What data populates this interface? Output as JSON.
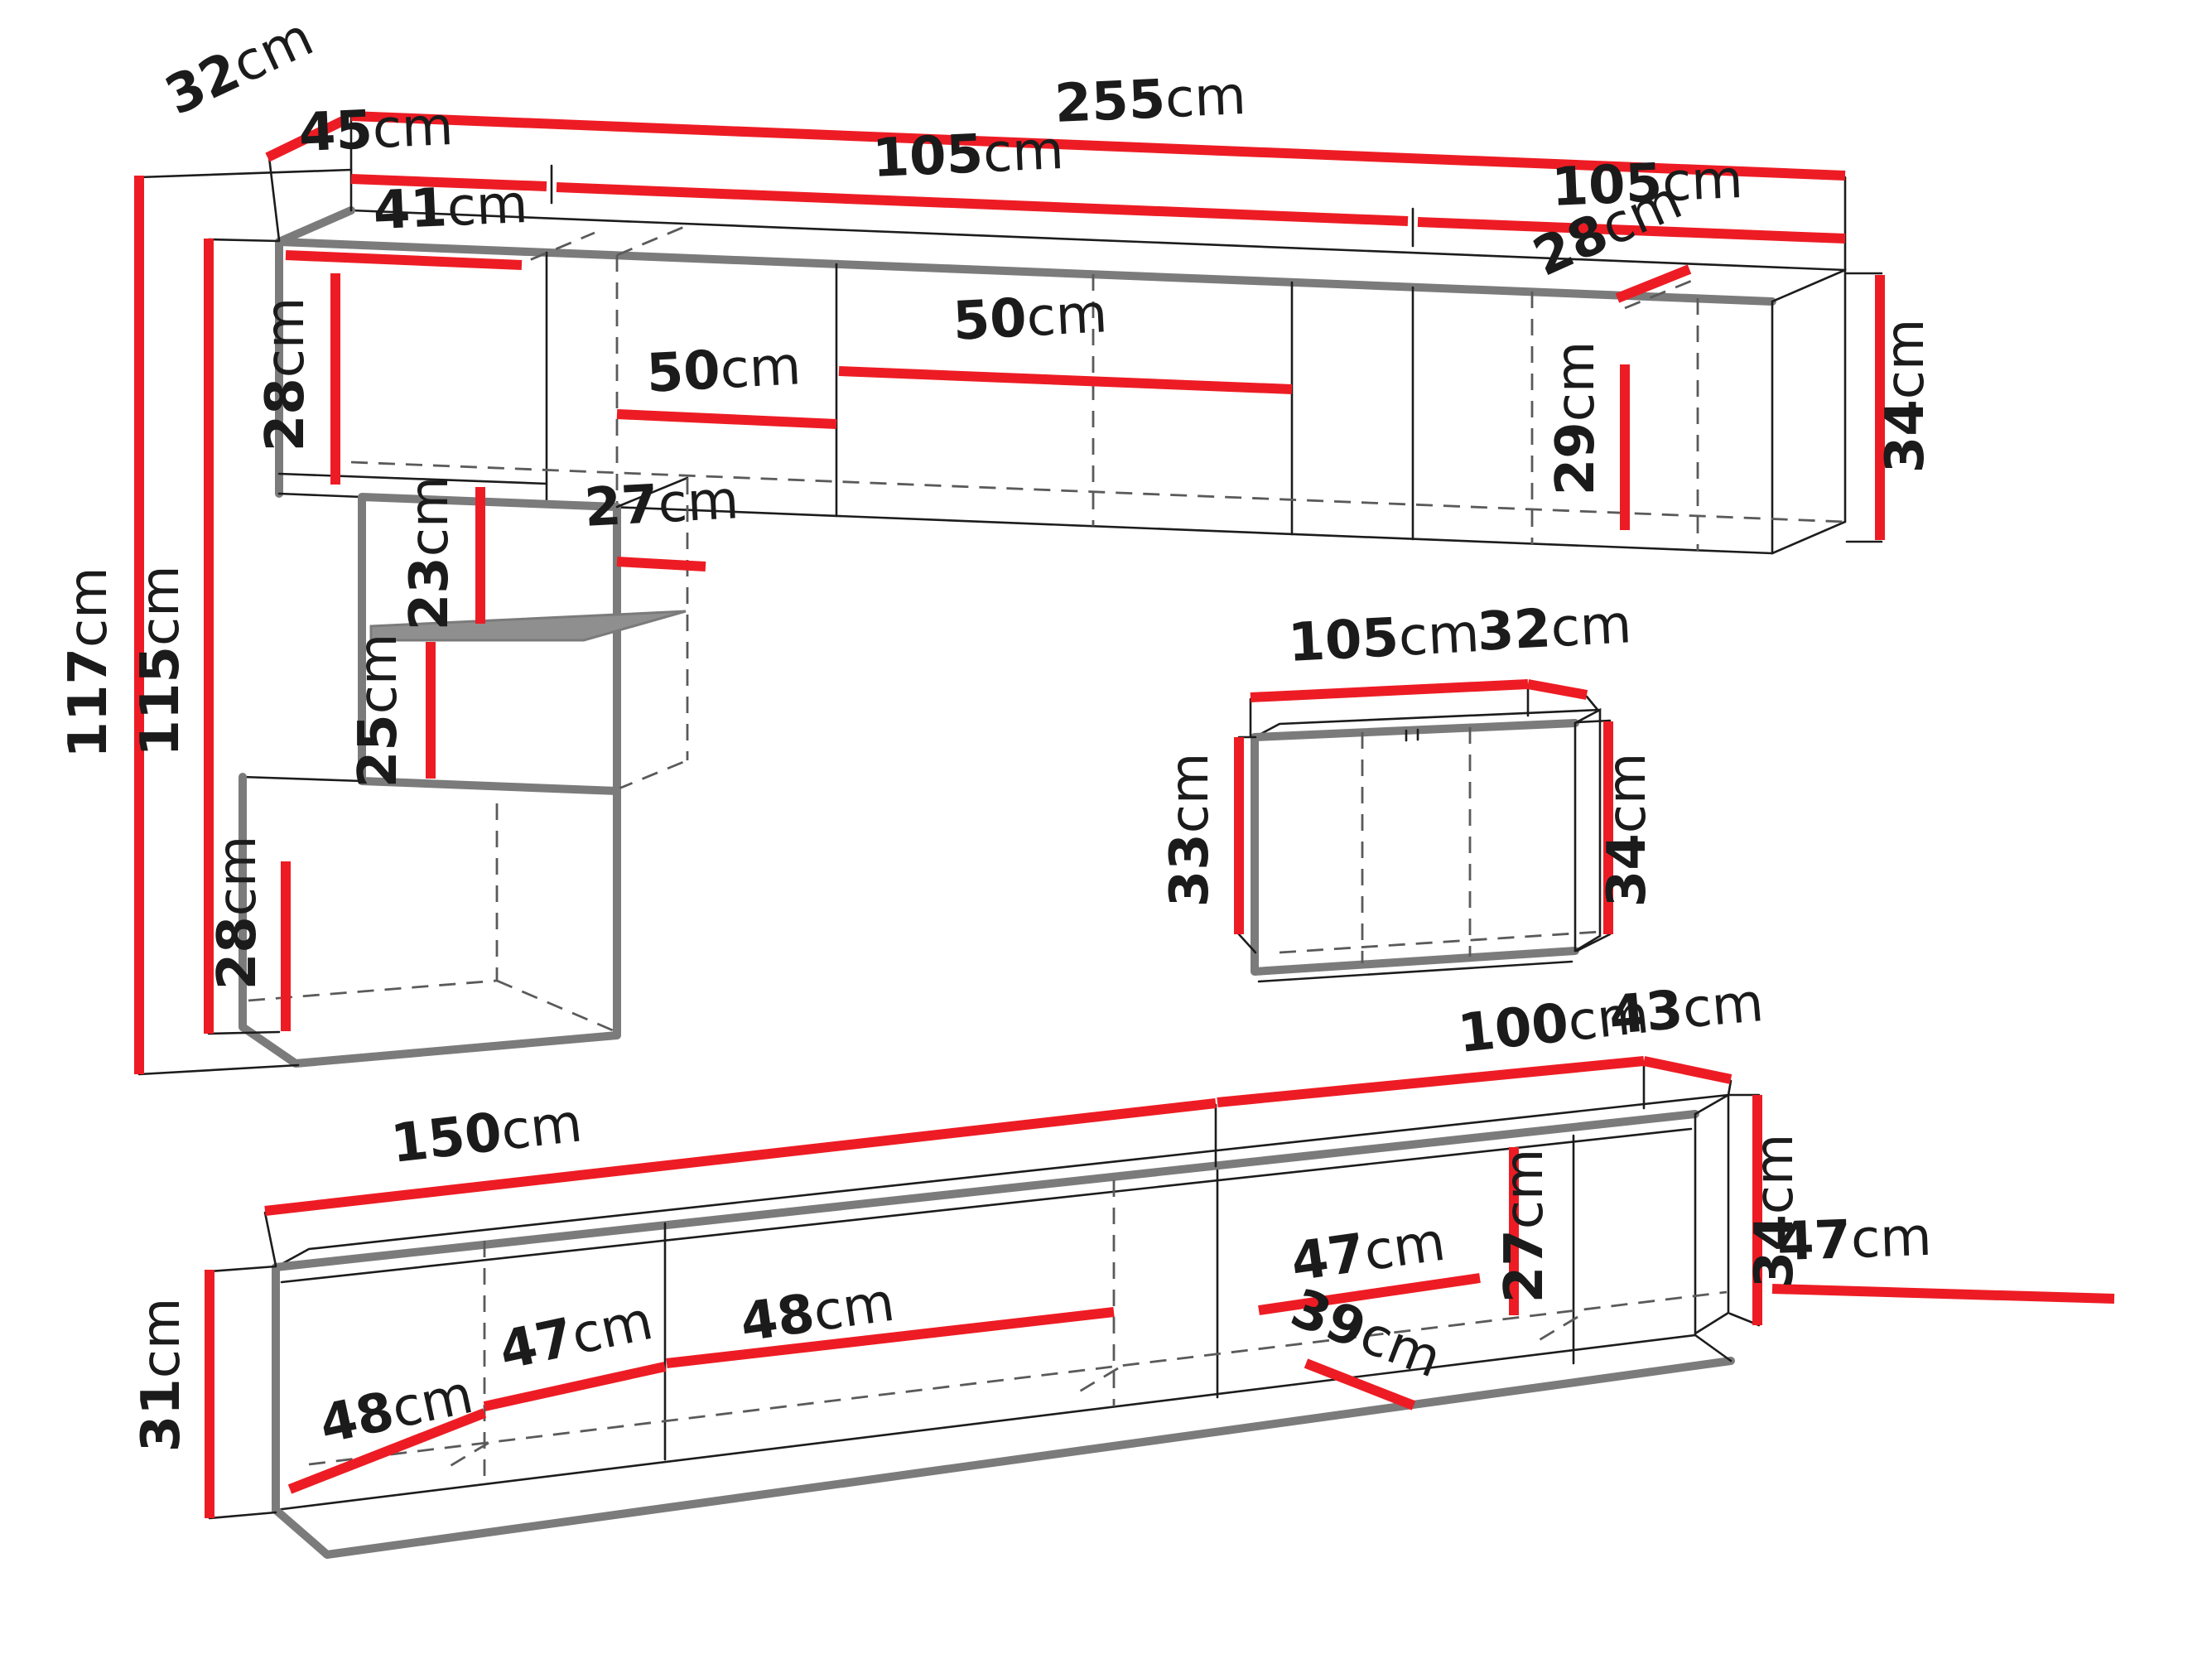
{
  "diagram": {
    "kind": "furniture-dimension-diagram",
    "unit": "cm",
    "accent_color": "#ed1c24",
    "outline_color": "#7b7b7b",
    "background": "#ffffff"
  },
  "dims": {
    "wall_unit": {
      "top_depth": {
        "num": "32",
        "unit": "cm"
      },
      "col_width": {
        "num": "45",
        "unit": "cm"
      },
      "total_width": {
        "num": "255",
        "unit": "cm"
      },
      "sec1_width": {
        "num": "105",
        "unit": "cm"
      },
      "sec2_width": {
        "num": "105",
        "unit": "cm"
      },
      "col_inner_width": {
        "num": "41",
        "unit": "cm"
      },
      "top_box_height": {
        "num": "28",
        "unit": "cm"
      },
      "total_height": {
        "num": "117",
        "unit": "cm"
      },
      "front_height": {
        "num": "115",
        "unit": "cm"
      },
      "above_shelf": {
        "num": "23",
        "unit": "cm"
      },
      "below_shelf": {
        "num": "25",
        "unit": "cm"
      },
      "mid_depth": {
        "num": "27",
        "unit": "cm"
      },
      "bottom_box_height": {
        "num": "28",
        "unit": "cm"
      },
      "shelf1_span": {
        "num": "50",
        "unit": "cm"
      },
      "shelf2_span": {
        "num": "50",
        "unit": "cm"
      },
      "right_depth": {
        "num": "28",
        "unit": "cm"
      },
      "right_inner_height": {
        "num": "29",
        "unit": "cm"
      },
      "right_height": {
        "num": "34",
        "unit": "cm"
      }
    },
    "floating_cabinet": {
      "width": {
        "num": "105",
        "unit": "cm"
      },
      "depth": {
        "num": "32",
        "unit": "cm"
      },
      "front_height": {
        "num": "33",
        "unit": "cm"
      },
      "side_height": {
        "num": "34",
        "unit": "cm"
      }
    },
    "tv_stand": {
      "left_span": {
        "num": "150",
        "unit": "cm"
      },
      "right_span": {
        "num": "100",
        "unit": "cm"
      },
      "depth": {
        "num": "43",
        "unit": "cm"
      },
      "front_height": {
        "num": "31",
        "unit": "cm"
      },
      "side_height": {
        "num": "34",
        "unit": "cm"
      },
      "sec1_width": {
        "num": "48",
        "unit": "cm"
      },
      "sec2_width": {
        "num": "47",
        "unit": "cm"
      },
      "sec3_width": {
        "num": "48",
        "unit": "cm"
      },
      "sec4_width": {
        "num": "47",
        "unit": "cm"
      },
      "floor_depth": {
        "num": "39",
        "unit": "cm"
      },
      "inner_height": {
        "num": "27",
        "unit": "cm"
      },
      "sec5_width": {
        "num": "47",
        "unit": "cm"
      }
    }
  }
}
